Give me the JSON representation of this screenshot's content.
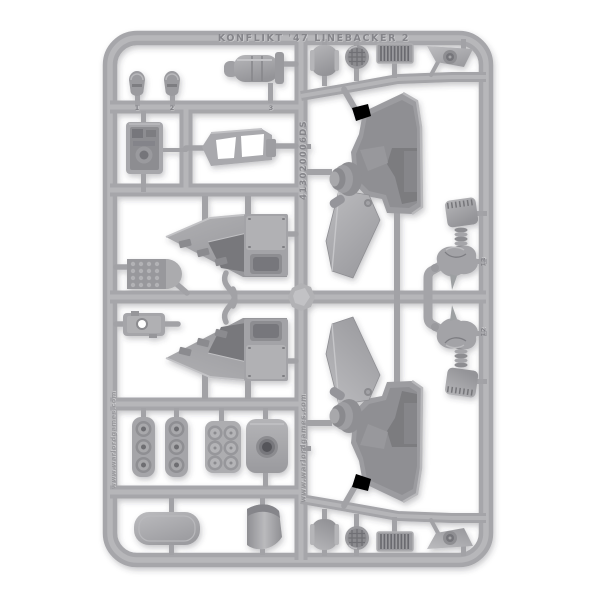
{
  "photo": {
    "alt": "Grey plastic model kit sprue with vehicle parts on a white background",
    "background": "#ffffff"
  },
  "colors": {
    "background": "#ffffff",
    "plastic_base": "#a6a6aa",
    "plastic_highlight": "#c6c6c9",
    "plastic_shadow": "#8e8e92",
    "recess_dark": "#75757a",
    "deep_hole": "#55555a",
    "embossed_text": "#85858a"
  },
  "sprue": {
    "embossed_top_text": "KONFLIKT '47 LINEBACKER 2",
    "embossed_code_text": "413020006DS",
    "embossed_site_text": "www.warlordgames.com",
    "part_numbers": {
      "n1": "1",
      "n2": "2",
      "n3": "3",
      "n12": "12",
      "n13": "13"
    }
  }
}
